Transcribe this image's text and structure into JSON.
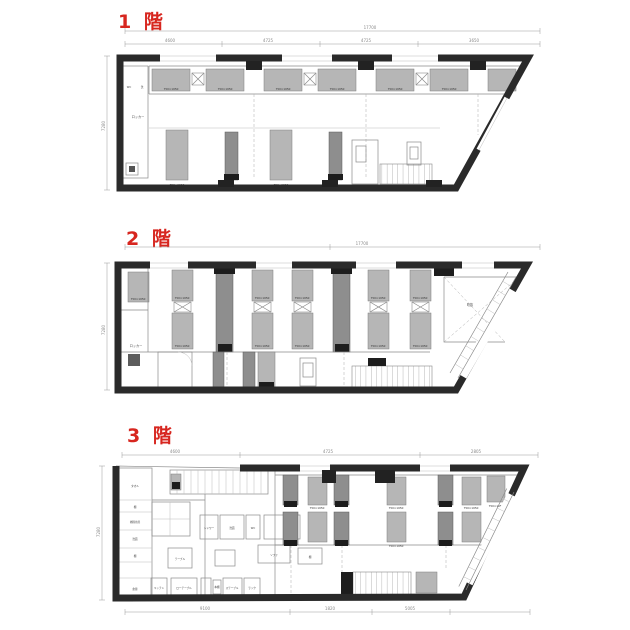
{
  "document": {
    "kind": "scanned floor plan sheet",
    "colors": {
      "label_red": "#d7261f",
      "wall": "#2a2a2a",
      "bed_light": "#b6b6b6",
      "bed_dark": "#8e8e8e"
    },
    "floors": [
      {
        "label": "1 階",
        "bed_size_label": "750×1950",
        "corridor_label": "ロッカー",
        "wc_label": "WC",
        "wash_label": "洗",
        "dims": {
          "overall": "17700",
          "segments": [
            "4600",
            "4725",
            "4725",
            "3650"
          ],
          "height": "7280"
        }
      },
      {
        "label": "2 階",
        "bed_size_label": "750×1950",
        "corridor_label": "ロッカー",
        "void_label": "吹抜",
        "dims": {
          "overall": "17700",
          "height": "7280"
        }
      },
      {
        "label": "3 階",
        "bed_size_label": "750×1950",
        "rooms": [
          "タオル",
          "棚",
          "掃除用具",
          "洗面",
          "倉庫",
          "シャワー",
          "WC",
          "テーブル",
          "ソファ",
          "キッチン",
          "ローテーブル",
          "本棚",
          "ステーブル",
          "ラック"
        ],
        "dims": {
          "top_segments": [
            "4600",
            "4725",
            "2805"
          ],
          "bottom_segments": [
            "9100",
            "1820",
            "5005"
          ],
          "height": "7280"
        }
      }
    ]
  }
}
